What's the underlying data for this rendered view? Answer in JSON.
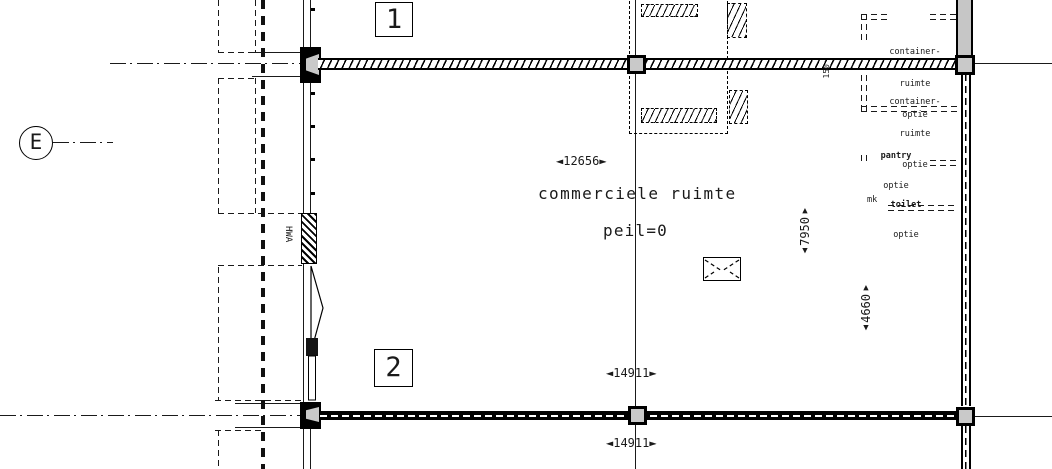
{
  "drawing": {
    "room_label": "commerciele ruimte",
    "level_label": "peil=0",
    "grid": {
      "e": "E",
      "row1": "1",
      "row2": "2"
    },
    "dimensions": {
      "width_top": "◄12656►",
      "width_bottom_inner": "◄14911►",
      "width_bottom_outer": "◄14911►",
      "height_right": {
        "up": "▲",
        "value": "7950",
        "down": "▼"
      },
      "height_right_lower": {
        "up": "▲",
        "value": "4660",
        "down": "▼"
      },
      "wall_thickness": "150"
    },
    "annotations": {
      "container_top": [
        "container-",
        "ruimte",
        "optie"
      ],
      "container_bottom": [
        "container-",
        "ruimte",
        "optie"
      ],
      "pantry": [
        "pantry",
        "optie"
      ],
      "toilet": [
        "toilet",
        "optie"
      ],
      "mk": "mk",
      "hwa": "HWA"
    }
  }
}
